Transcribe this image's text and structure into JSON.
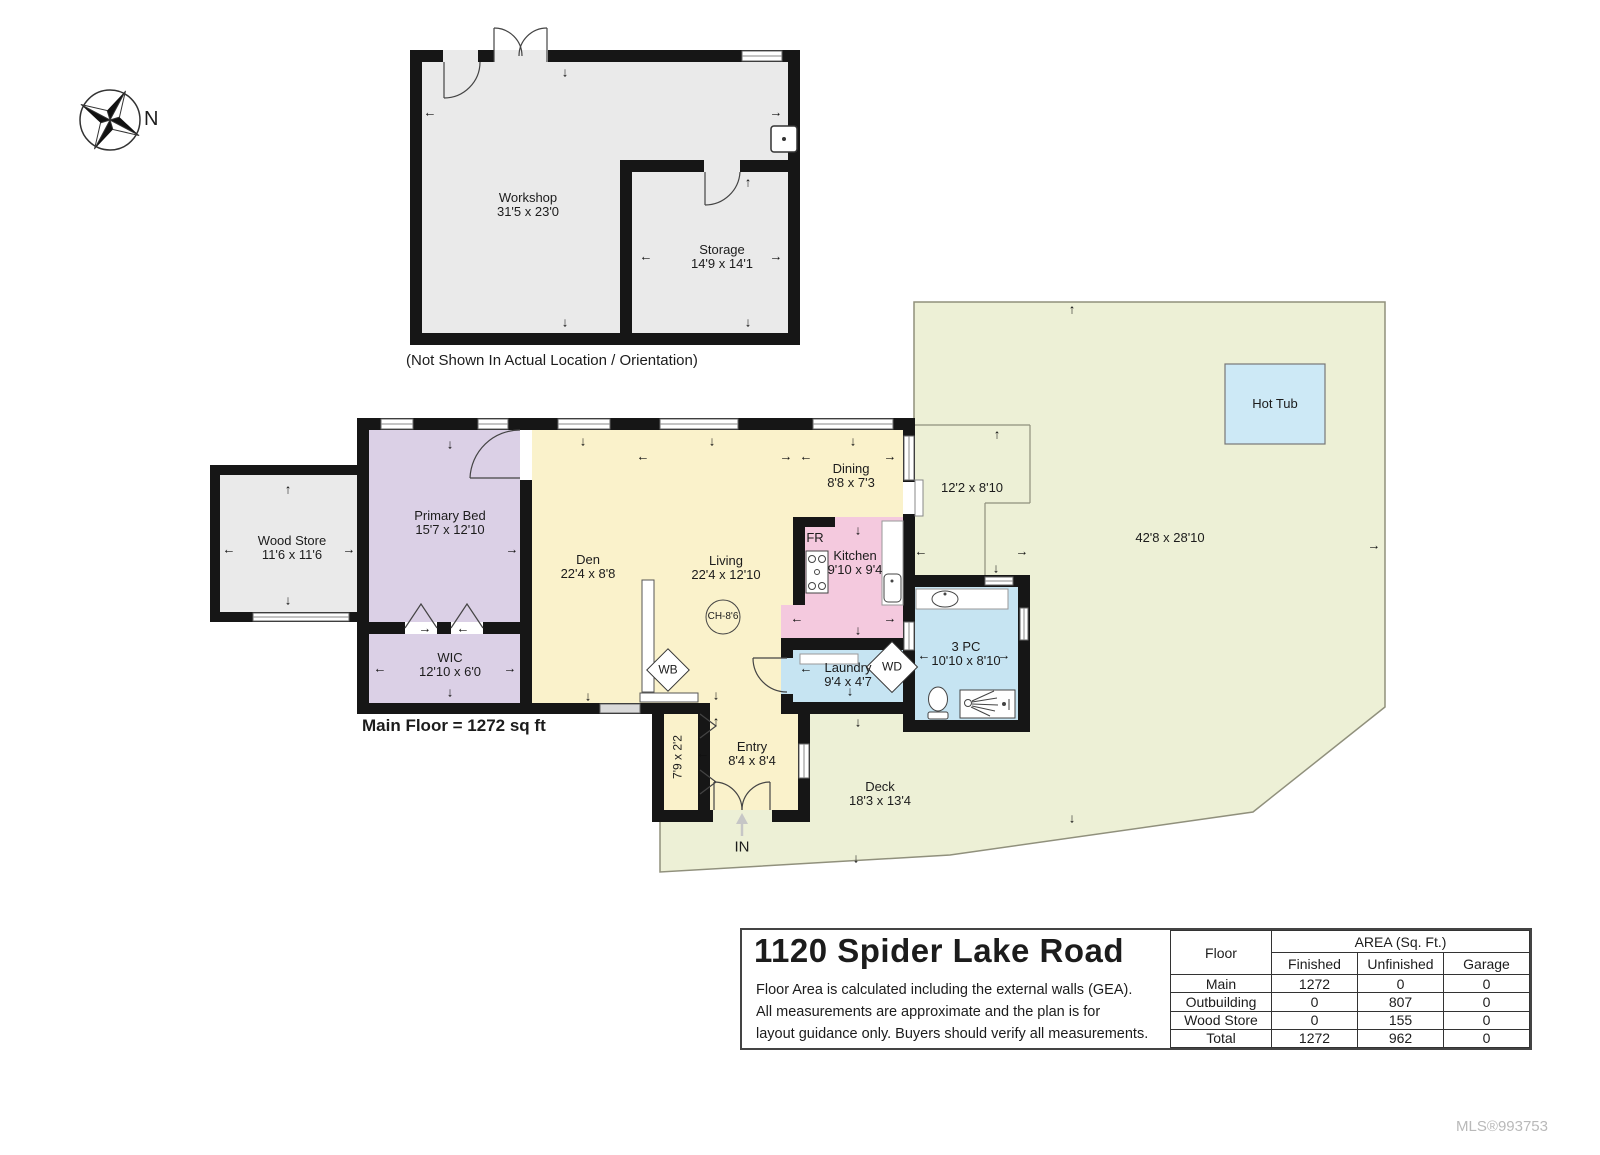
{
  "compass": {
    "n": "N"
  },
  "outbuilding": {
    "workshop": {
      "name": "Workshop",
      "dims": "31'5 x 23'0"
    },
    "storage": {
      "name": "Storage",
      "dims": "14'9 x 14'1"
    },
    "note": "(Not Shown In Actual Location / Orientation)"
  },
  "rooms": {
    "wood_store": {
      "name": "Wood Store",
      "dims": "11'6 x 11'6"
    },
    "primary_bed": {
      "name": "Primary Bed",
      "dims": "15'7 x 12'10"
    },
    "wic": {
      "name": "WIC",
      "dims": "12'10 x 6'0"
    },
    "den": {
      "name": "Den",
      "dims": "22'4 x 8'8"
    },
    "living": {
      "name": "Living",
      "dims": "22'4 x 12'10",
      "ceiling": "CH-8'6",
      "wood_burner": "WB"
    },
    "dining": {
      "name": "Dining",
      "dims": "8'8 x 7'3"
    },
    "kitchen": {
      "name": "Kitchen",
      "dims": "9'10 x 9'4",
      "fridge": "FR"
    },
    "laundry": {
      "name": "Laundry",
      "dims": "9'4 x 4'7",
      "washer_dryer": "WD"
    },
    "bath": {
      "name": "3 PC",
      "dims": "10'10 x 8'10"
    },
    "entry": {
      "name": "Entry",
      "dims": "8'4 x 8'4",
      "closet_dims": "7'9 x 2'2",
      "in_label": "IN"
    },
    "deck": {
      "name": "Deck",
      "dims": "18'3 x 13'4",
      "small_dims": "12'2 x 8'10",
      "large_dims": "42'8 x 28'10"
    },
    "hot_tub": {
      "name": "Hot Tub"
    }
  },
  "plan": {
    "main_floor_total": "Main Floor = 1272 sq ft"
  },
  "info": {
    "title": "1120 Spider Lake Road",
    "disclaimer_lines": [
      "Floor Area is calculated including the external walls (GEA).",
      "All measurements are approximate and the plan is for",
      "layout guidance only. Buyers should verify all measurements."
    ]
  },
  "table": {
    "floor_header": "Floor",
    "area_header": "AREA (Sq. Ft.)",
    "columns": [
      "Finished",
      "Unfinished",
      "Garage"
    ],
    "rows": [
      {
        "floor": "Main",
        "finished": "1272",
        "unfinished": "0",
        "garage": "0"
      },
      {
        "floor": "Outbuilding",
        "finished": "0",
        "unfinished": "807",
        "garage": "0"
      },
      {
        "floor": "Wood Store",
        "finished": "0",
        "unfinished": "155",
        "garage": "0"
      },
      {
        "floor": "Total",
        "finished": "1272",
        "unfinished": "962",
        "garage": "0"
      }
    ]
  },
  "footer": {
    "mls": "MLS®993753"
  },
  "icons": {
    "arrow_up": "↑",
    "arrow_down": "↓",
    "arrow_left": "←",
    "arrow_right": "→"
  }
}
